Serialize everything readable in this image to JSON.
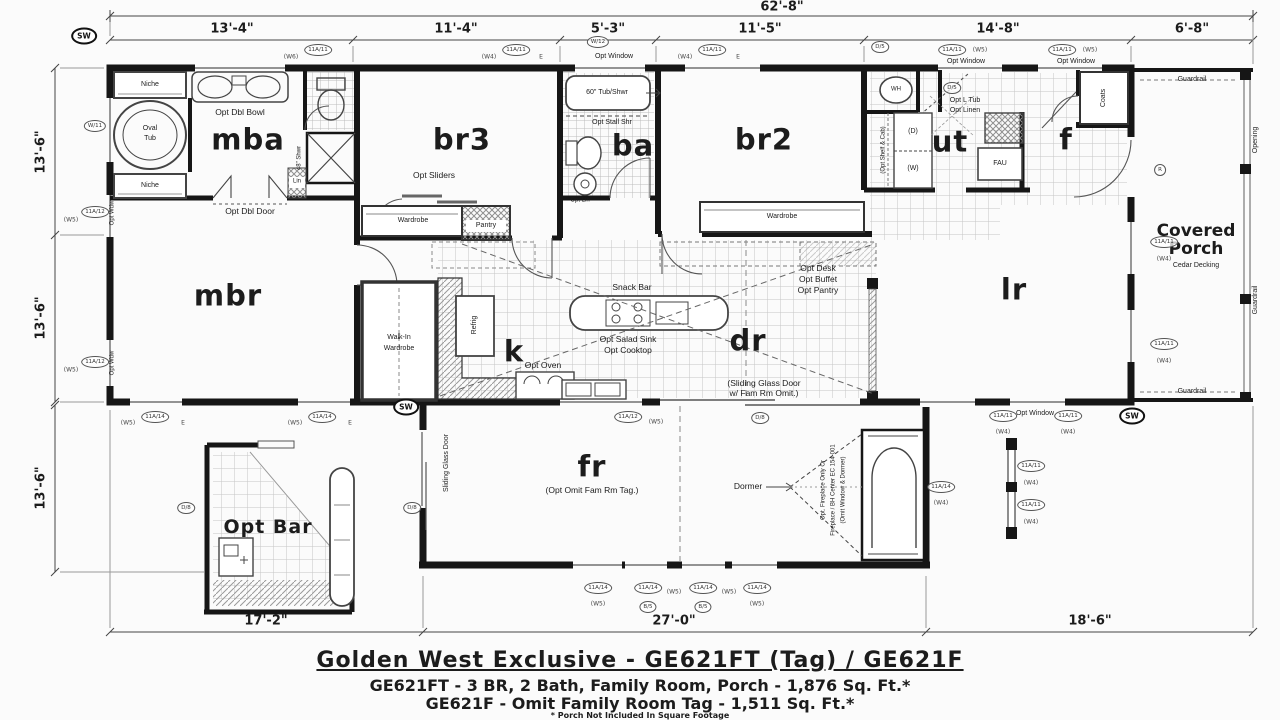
{
  "title_block": {
    "line1": "Golden West Exclusive - GE621FT (Tag) / GE621F",
    "line2": "GE621FT - 3 BR, 2 Bath, Family Room, Porch - 1,876 Sq. Ft.*",
    "line3": "GE621F - Omit Family Room Tag - 1,511 Sq. Ft.*",
    "footnote": "* Porch Not Included In Square Footage"
  },
  "dimensions": {
    "overall": "62'-8\"",
    "top": [
      "13'-4\"",
      "11'-4\"",
      "5'-3\"",
      "11'-5\"",
      "14'-8\"",
      "6'-8\""
    ],
    "left": [
      "13'-6\"",
      "13'-6\"",
      "13'-6\""
    ],
    "bottom": [
      "17'-2\"",
      "27'-0\"",
      "18'-6\""
    ]
  },
  "rooms": {
    "mba": "mba",
    "mbr": "mbr",
    "br3": "br3",
    "ba": "ba",
    "br2": "br2",
    "ut": "ut",
    "f": "f",
    "k": "k",
    "dr": "dr",
    "lr": "lr",
    "fr": "fr",
    "opt_bar": "Opt Bar",
    "covered_porch": "Covered Porch",
    "cedar": "Cedar Decking"
  },
  "annotations": {
    "niche_top": "Niche",
    "niche_bottom": "Niche",
    "opt_dbl_bowl": "Opt Dbl Bowl",
    "oval": "Oval",
    "tub": "Tub",
    "lin": "Lin",
    "shwr48": "48\" Shwr",
    "opt_dbl_door": "Opt Dbl Door",
    "walkin1": "Walk-In",
    "walkin2": "Wardrobe",
    "opt_sliders": "Opt Sliders",
    "wardrobe1": "Wardrobe",
    "pantry": "Pantry",
    "tub60": "60\" Tub/Shwr",
    "opt_stall": "Opt Stall Shr",
    "opt_lin": "Opt Lin",
    "wardrobe2": "Wardrobe",
    "wh": "WH",
    "d": "(D)",
    "w": "(W)",
    "shelf_cab": "(Opt Shelf & Cab)",
    "opt_l_tub": "Opt L Tub",
    "opt_linen": "Opt Linen",
    "fau": "FAU",
    "coats": "Coats",
    "opt_window1": "Opt Window",
    "opt_window2": "Opt Window",
    "opt_window3": "Opt Window",
    "opt_window4": "Opt Window",
    "guardrail_top": "Guardrail",
    "guardrail_bottom": "Guardrail",
    "guardrail_right": "Guardrail",
    "opening": "Opening",
    "snack_bar": "Snack Bar",
    "opt_salad": "Opt Salad Sink",
    "opt_cooktop": "Opt Cooktop",
    "opt_oven": "Opt Oven",
    "refrig": "Refrig",
    "opt_desk": "Opt Desk",
    "opt_buffet": "Opt Buffet",
    "opt_pantry": "Opt Pantry",
    "sliding1": "(Sliding Glass Door",
    "sliding2": "w/ Fam Rm Omit.)",
    "sgd_vert": "Sliding Glass Door",
    "fr_note": "(Opt Omit Fam Rm Tag.)",
    "dormer": "Dormer",
    "fp1": "Opt. Fireplace Only Or",
    "fp2": "Fireplace / BH Center EC 154-001",
    "fp3": "(Omit Window & Dormer)",
    "opt_wdw1": "Opt Wdw",
    "opt_wdw2": "Opt Wdw"
  },
  "bubbles": [
    {
      "x": 84,
      "y": 36,
      "t": "SW",
      "s": "o"
    },
    {
      "x": 406,
      "y": 407,
      "t": "SW",
      "s": "o"
    },
    {
      "x": 1132,
      "y": 416,
      "t": "SW",
      "s": "o"
    },
    {
      "x": 318,
      "y": 50,
      "t": "11A/11",
      "s": "c"
    },
    {
      "x": 291,
      "y": 57,
      "t": "(W6)",
      "s": "p"
    },
    {
      "x": 516,
      "y": 50,
      "t": "11A/11",
      "s": "c"
    },
    {
      "x": 489,
      "y": 57,
      "t": "(W4)",
      "s": "p"
    },
    {
      "x": 541,
      "y": 57,
      "t": "E",
      "s": "p"
    },
    {
      "x": 598,
      "y": 42,
      "t": "W/12",
      "s": "c"
    },
    {
      "x": 712,
      "y": 50,
      "t": "11A/11",
      "s": "c"
    },
    {
      "x": 685,
      "y": 57,
      "t": "(W4)",
      "s": "p"
    },
    {
      "x": 738,
      "y": 57,
      "t": "E",
      "s": "p"
    },
    {
      "x": 880,
      "y": 47,
      "t": "D/5",
      "s": "c"
    },
    {
      "x": 952,
      "y": 50,
      "t": "11A/11",
      "s": "c"
    },
    {
      "x": 980,
      "y": 50,
      "t": "(W5)",
      "s": "p"
    },
    {
      "x": 1062,
      "y": 50,
      "t": "11A/11",
      "s": "c"
    },
    {
      "x": 1090,
      "y": 50,
      "t": "(W5)",
      "s": "p"
    },
    {
      "x": 95,
      "y": 126,
      "t": "W/11",
      "s": "c"
    },
    {
      "x": 95,
      "y": 212,
      "t": "11A/12",
      "s": "c"
    },
    {
      "x": 71,
      "y": 220,
      "t": "(W5)",
      "s": "p"
    },
    {
      "x": 95,
      "y": 362,
      "t": "11A/12",
      "s": "c"
    },
    {
      "x": 71,
      "y": 370,
      "t": "(W5)",
      "s": "p"
    },
    {
      "x": 155,
      "y": 417,
      "t": "11A/14",
      "s": "c"
    },
    {
      "x": 128,
      "y": 423,
      "t": "(W5)",
      "s": "p"
    },
    {
      "x": 183,
      "y": 423,
      "t": "E",
      "s": "p"
    },
    {
      "x": 322,
      "y": 417,
      "t": "11A/14",
      "s": "c"
    },
    {
      "x": 295,
      "y": 423,
      "t": "(W5)",
      "s": "p"
    },
    {
      "x": 350,
      "y": 423,
      "t": "E",
      "s": "p"
    },
    {
      "x": 628,
      "y": 417,
      "t": "11A/12",
      "s": "c"
    },
    {
      "x": 656,
      "y": 422,
      "t": "(W5)",
      "s": "p"
    },
    {
      "x": 760,
      "y": 418,
      "t": "D/8",
      "s": "c"
    },
    {
      "x": 952,
      "y": 88,
      "t": "D/5",
      "s": "c"
    },
    {
      "x": 1160,
      "y": 170,
      "t": "R",
      "s": "c"
    },
    {
      "x": 1164,
      "y": 242,
      "t": "11A/11",
      "s": "c"
    },
    {
      "x": 1164,
      "y": 259,
      "t": "(W4)",
      "s": "p"
    },
    {
      "x": 1164,
      "y": 344,
      "t": "11A/11",
      "s": "c"
    },
    {
      "x": 1164,
      "y": 361,
      "t": "(W4)",
      "s": "p"
    },
    {
      "x": 412,
      "y": 508,
      "t": "D/8",
      "s": "c"
    },
    {
      "x": 186,
      "y": 508,
      "t": "D/8",
      "s": "c"
    },
    {
      "x": 598,
      "y": 588,
      "t": "11A/14",
      "s": "c"
    },
    {
      "x": 598,
      "y": 604,
      "t": "(W5)",
      "s": "p"
    },
    {
      "x": 648,
      "y": 588,
      "t": "11A/14",
      "s": "c"
    },
    {
      "x": 674,
      "y": 592,
      "t": "(W5)",
      "s": "p"
    },
    {
      "x": 648,
      "y": 607,
      "t": "B/5",
      "s": "c"
    },
    {
      "x": 703,
      "y": 588,
      "t": "11A/14",
      "s": "c"
    },
    {
      "x": 729,
      "y": 592,
      "t": "(W5)",
      "s": "p"
    },
    {
      "x": 703,
      "y": 607,
      "t": "B/5",
      "s": "c"
    },
    {
      "x": 757,
      "y": 588,
      "t": "11A/14",
      "s": "c"
    },
    {
      "x": 757,
      "y": 604,
      "t": "(W5)",
      "s": "p"
    },
    {
      "x": 941,
      "y": 487,
      "t": "11A/14",
      "s": "c"
    },
    {
      "x": 941,
      "y": 503,
      "t": "(W4)",
      "s": "p"
    },
    {
      "x": 1003,
      "y": 416,
      "t": "11A/11",
      "s": "c"
    },
    {
      "x": 1003,
      "y": 432,
      "t": "(W4)",
      "s": "p"
    },
    {
      "x": 1068,
      "y": 416,
      "t": "11A/11",
      "s": "c"
    },
    {
      "x": 1068,
      "y": 432,
      "t": "(W4)",
      "s": "p"
    },
    {
      "x": 1031,
      "y": 466,
      "t": "11A/11",
      "s": "c"
    },
    {
      "x": 1031,
      "y": 483,
      "t": "(W4)",
      "s": "p"
    },
    {
      "x": 1031,
      "y": 505,
      "t": "11A/11",
      "s": "c"
    },
    {
      "x": 1031,
      "y": 522,
      "t": "(W4)",
      "s": "p"
    }
  ]
}
